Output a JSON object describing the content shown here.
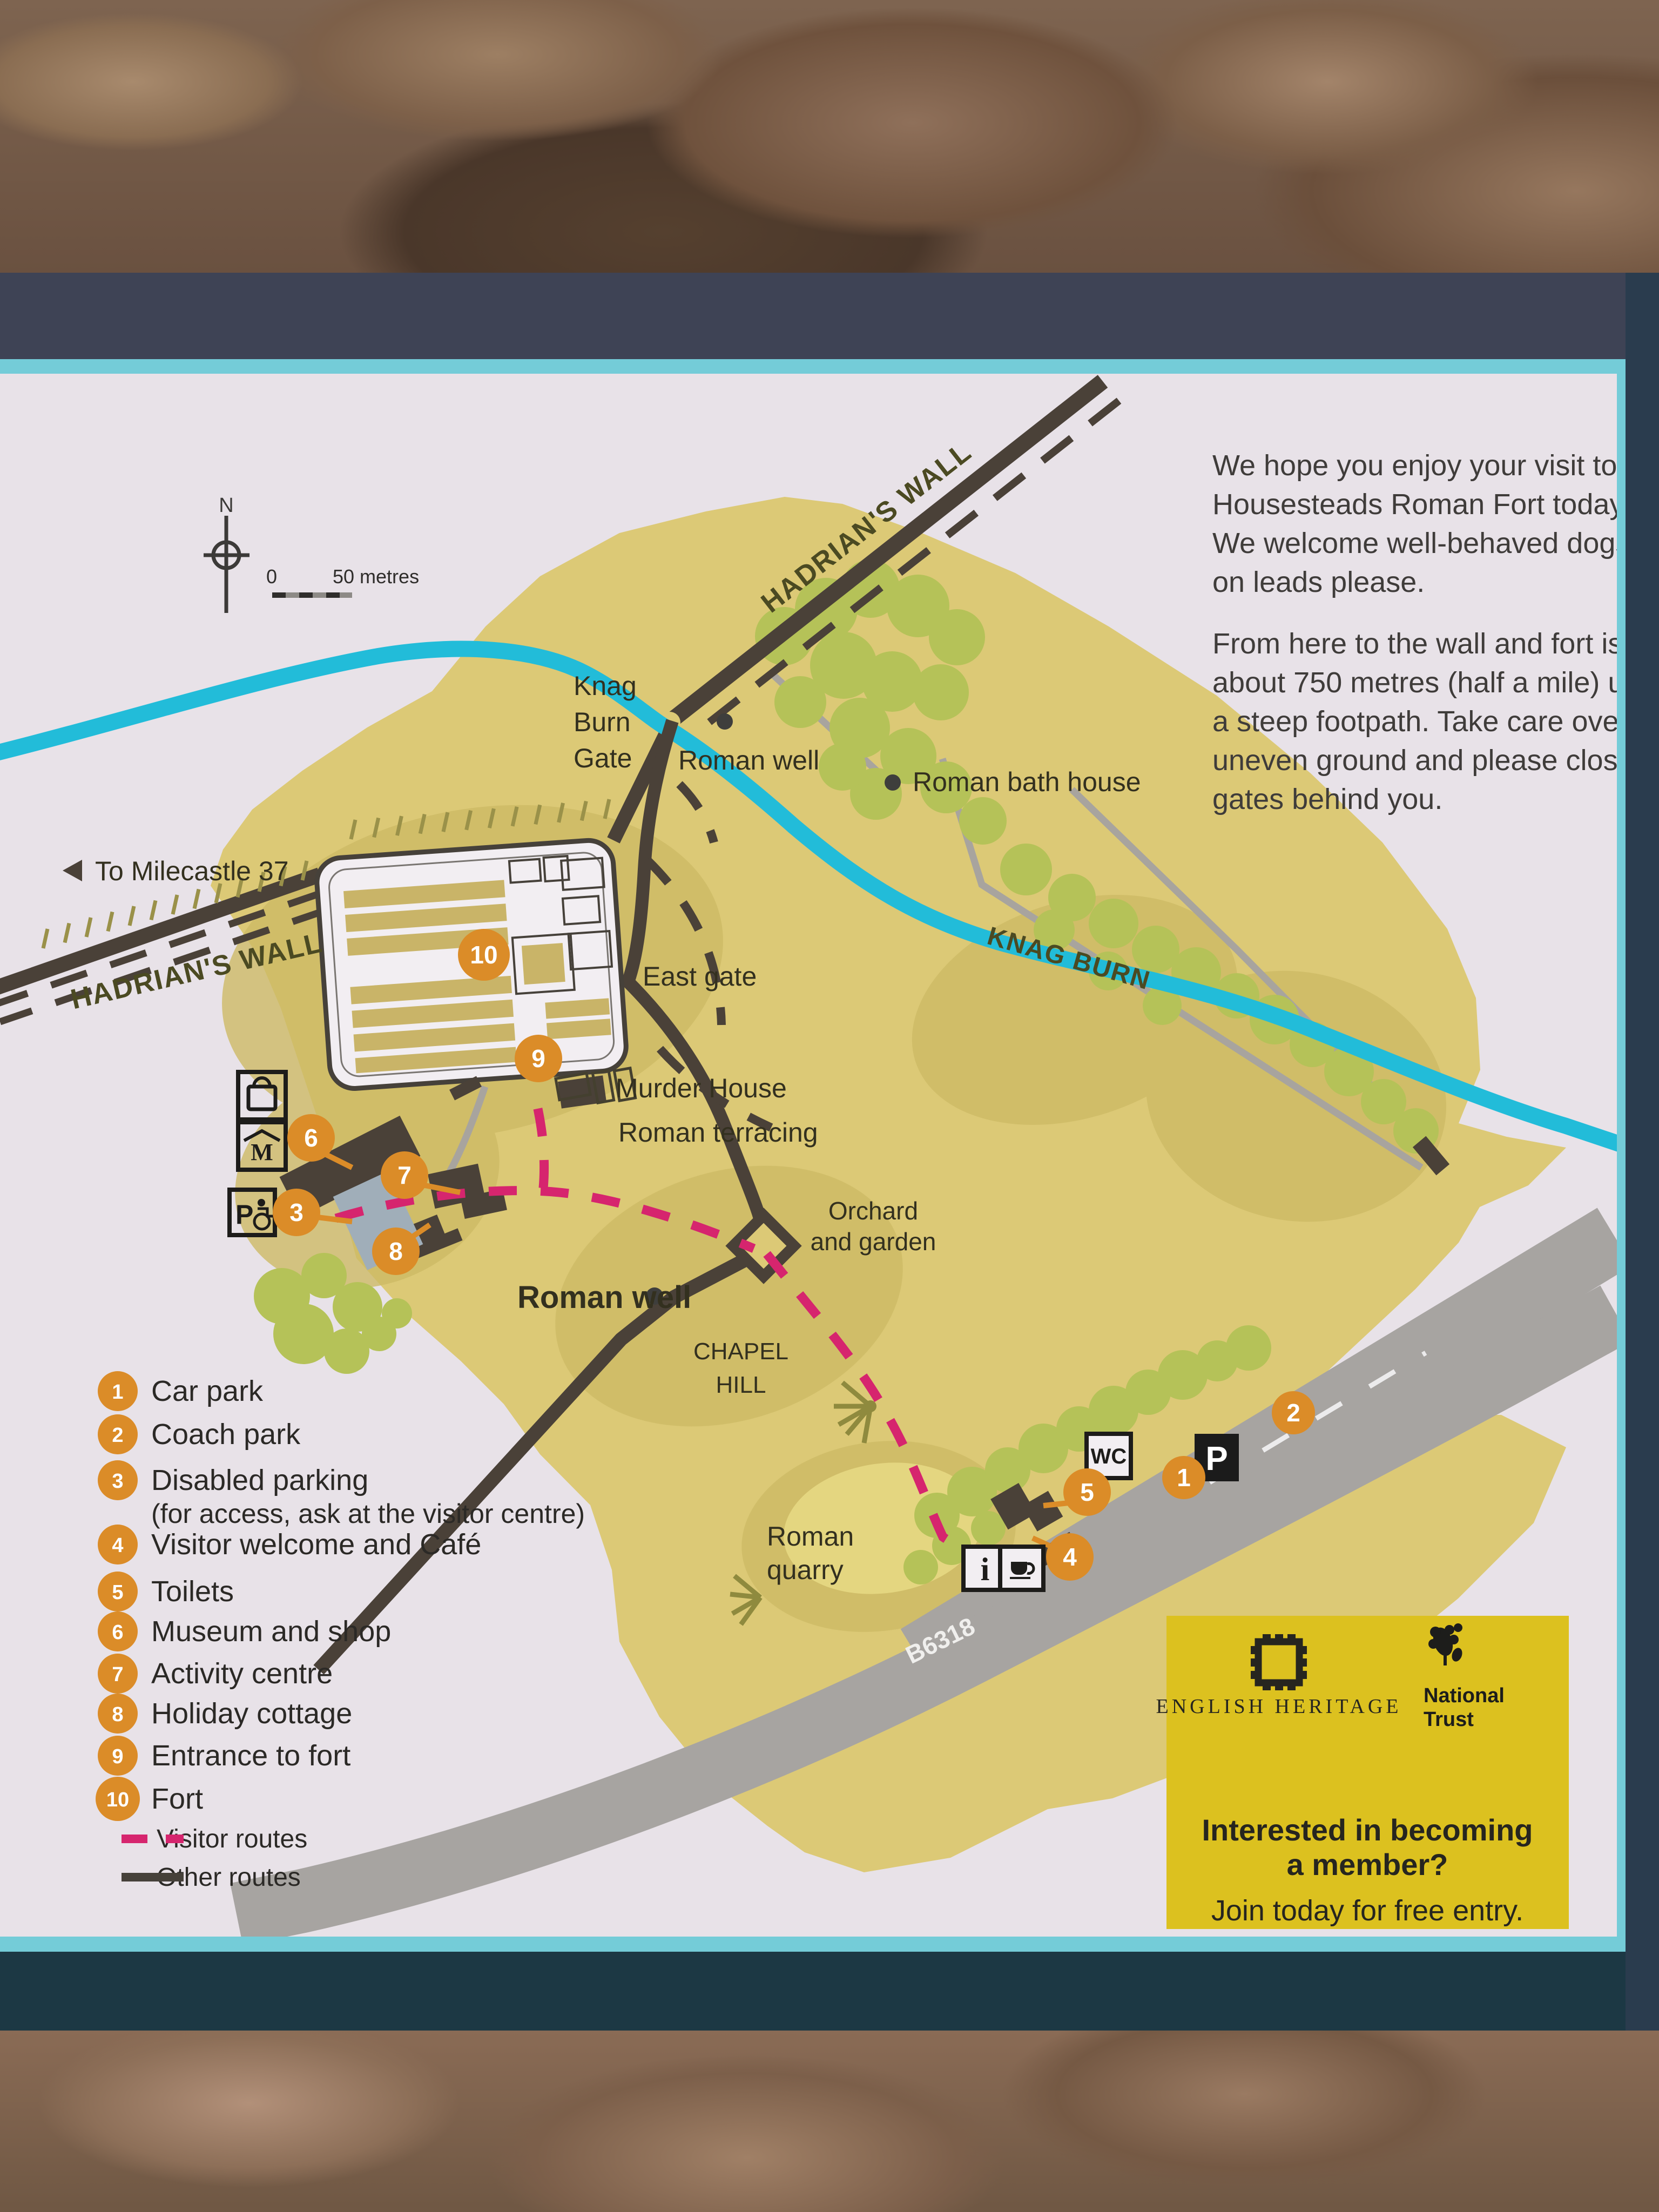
{
  "sign": {
    "welcome_p1": [
      "We hope you enjoy your visit to",
      "Housesteads Roman Fort today.",
      "We welcome well-behaved dogs,",
      "on leads please."
    ],
    "welcome_p2": [
      "From here to the wall and fort is",
      "about 750 metres (half a mile) up",
      "a steep footpath. Take care over",
      "uneven ground and please close",
      "gates behind you."
    ]
  },
  "compass": {
    "north": "N"
  },
  "scale_bar": {
    "zero": "0",
    "label": "50 metres"
  },
  "map_labels": {
    "hadrians_wall_ne": "HADRIAN'S WALL",
    "hadrians_wall_w": "HADRIAN'S WALL",
    "knag_burn_gate_l1": "Knag",
    "knag_burn_gate_l2": "Burn",
    "knag_burn_gate_l3": "Gate",
    "roman_well_top": "Roman well",
    "roman_bath_house": "Roman bath house",
    "knag_burn": "KNAG BURN",
    "to_milecastle": "To Milecastle 37",
    "east_gate": "East gate",
    "murder_house": "Murder House",
    "roman_terracing": "Roman terracing",
    "roman_well_lower": "Roman well",
    "chapel_hill_l1": "CHAPEL",
    "chapel_hill_l2": "HILL",
    "orchard_l1": "Orchard",
    "orchard_l2": "and garden",
    "roman_quarry_l1": "Roman",
    "roman_quarry_l2": "quarry",
    "road_b6318": "B6318"
  },
  "markers": {
    "m1": "1",
    "m2": "2",
    "m3": "3",
    "m4": "4",
    "m5": "5",
    "m6": "6",
    "m7": "7",
    "m8": "8",
    "m9": "9",
    "m10": "10"
  },
  "icons": {
    "wc": "WC",
    "parking": "P",
    "disabled_parking": "P",
    "info": "i",
    "museum_letter": "M"
  },
  "legend": {
    "items": [
      {
        "num": "1",
        "label": "Car park"
      },
      {
        "num": "2",
        "label": "Coach park"
      },
      {
        "num": "3",
        "label": "Disabled parking"
      },
      {
        "num": "4",
        "label": "Visitor welcome and Café"
      },
      {
        "num": "5",
        "label": "Toilets"
      },
      {
        "num": "6",
        "label": "Museum and shop"
      },
      {
        "num": "7",
        "label": "Activity centre"
      },
      {
        "num": "8",
        "label": "Holiday cottage"
      },
      {
        "num": "9",
        "label": "Entrance to fort"
      },
      {
        "num": "10",
        "label": "Fort"
      }
    ],
    "note3": "(for access, ask at the visitor centre)",
    "visitor_routes": "Visitor routes",
    "other_routes": "Other routes"
  },
  "membership": {
    "eh": "ENGLISH HERITAGE",
    "nt_l1": "National",
    "nt_l2": "Trust",
    "headline_l1": "Interested in becoming",
    "headline_l2": "a member?",
    "cta": "Join today for free entry."
  },
  "colors": {
    "panel": "#e8e2e8",
    "land": "#dcc976",
    "hill_shade": "#cdbb66",
    "stream": "#22bcd9",
    "dark_route": "#4a4138",
    "gray_path": "#a8a49e",
    "road_gray": "#a7a4a1",
    "visitor_route_pink": "#d6256e",
    "marker_orange": "#db8c28",
    "tree_green": "#b5c258",
    "membership_yellow": "#dcc11f",
    "frame_navy": "#3e4355",
    "frame_teal": "#1c3844",
    "border_cyan": "#74ccd8"
  }
}
